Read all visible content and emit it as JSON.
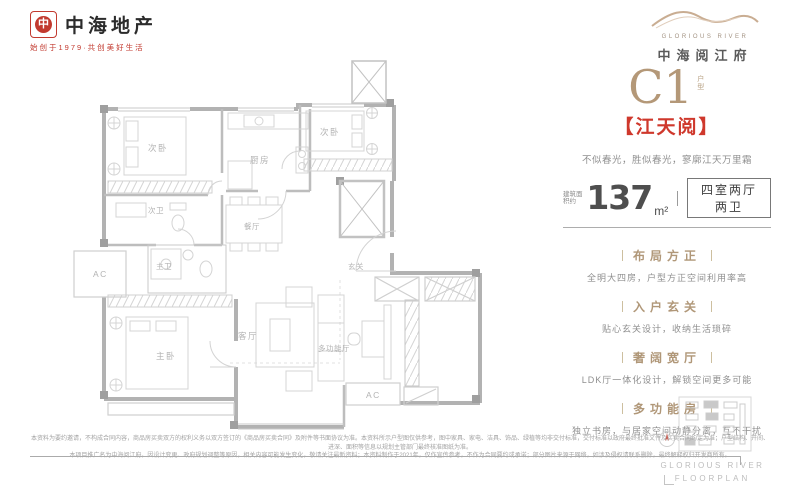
{
  "colors": {
    "accent_tan": "#b49878",
    "brand_red": "#c23a2f",
    "title_red": "#cf382c"
  },
  "brand": {
    "name": "中海地产",
    "tagline": "始创于1979·共创美好生活",
    "mark_glyph": "中"
  },
  "project": {
    "name_en": "GLORIOUS RIVER",
    "name_cn": "中海阅江府"
  },
  "unit": {
    "code": "C1",
    "code_suffix": "户型",
    "title": "【江天阅】",
    "slogan": "不似春光，胜似春光，寥廓江天万里霜",
    "area_prefix": "建筑面积约",
    "area_value": "137",
    "area_unit": "m²",
    "layout_spec": "四室两厅两卫"
  },
  "features": [
    {
      "title": "布局方正",
      "desc": "全明大四房，户型方正空间利用率高"
    },
    {
      "title": "入户玄关",
      "desc": "贴心玄关设计，收纳生活琐碎"
    },
    {
      "title": "奢阔宽厅",
      "desc": "LDK厅一体化设计，解锁空间更多可能"
    },
    {
      "title": "多功能房",
      "desc": "独立书房，与居家空间动静分离，互不干扰"
    }
  ],
  "floorplan": {
    "labels": {
      "bedroom_top_left": "次卧",
      "kitchen": "厨房",
      "bedroom_top_right": "次卧",
      "bath_second": "次卫",
      "bath_master": "主卫",
      "master_bedroom": "主卧",
      "dining": "餐厅",
      "living": "客厅",
      "multi_room": "多功能厅",
      "foyer": "玄关",
      "ac_left": "AC",
      "ac_bottom": "AC"
    }
  },
  "footer": {
    "caption_en_1": "GLORIOUS RIVER",
    "caption_en_2": "FLOORPLAN",
    "disclaimer_1": "本资料为要约邀请，不构成合同内容，商品房买卖双方的权利义务以双方签订的《商品房买卖合同》及附件等书面协议为准。本资料所示户型图仅供参考，图中家具、家电、洁具、饰品、绿植等均非交付标准，交付标准以政府最终批准文件及买卖合同约定为准；户型结构、开间、进深、面积等信息以规划主管部门最终核准图纸为准。",
    "disclaimer_2": "本项目推广名为中海阅江府。因设计变更、政府规划调整等原因，相关内容可能发生变化，敬请关注最新资料；本资料制作于2021年，仅作宣传参考，不作为合同要约或承诺；部分图片来源于网络，如涉及侵权请联系删除，最终解释权归开发商所有。"
  }
}
